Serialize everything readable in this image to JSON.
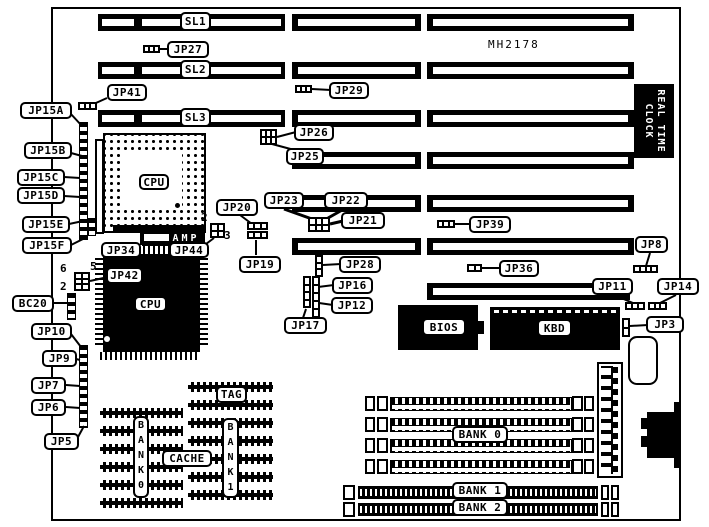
{
  "silkscreen": {
    "board_id": "MH2178",
    "rtc_line1": "REAL TIME",
    "rtc_line2": "CLOCK",
    "amp_label": "AMP"
  },
  "callouts": [
    {
      "name": "sl1-label",
      "text": "SL1",
      "x": 180,
      "y": 12,
      "w": 31,
      "h": 19
    },
    {
      "name": "sl2-label",
      "text": "SL2",
      "x": 180,
      "y": 60,
      "w": 31,
      "h": 19
    },
    {
      "name": "sl3-label",
      "text": "SL3",
      "x": 180,
      "y": 108,
      "w": 31,
      "h": 19
    },
    {
      "name": "jp27-label",
      "text": "JP27",
      "x": 167,
      "y": 41,
      "w": 42,
      "h": 17
    },
    {
      "name": "jp41-label",
      "text": "JP41",
      "x": 107,
      "y": 84,
      "w": 40,
      "h": 17
    },
    {
      "name": "jp29-label",
      "text": "JP29",
      "x": 329,
      "y": 82,
      "w": 40,
      "h": 17
    },
    {
      "name": "jp26-label",
      "text": "JP26",
      "x": 294,
      "y": 124,
      "w": 40,
      "h": 17
    },
    {
      "name": "jp25-label",
      "text": "JP25",
      "x": 286,
      "y": 148,
      "w": 38,
      "h": 17
    },
    {
      "name": "jp15a-label",
      "text": "JP15A",
      "x": 20,
      "y": 102,
      "w": 52,
      "h": 17
    },
    {
      "name": "jp15b-label",
      "text": "JP15B",
      "x": 24,
      "y": 142,
      "w": 48,
      "h": 17
    },
    {
      "name": "jp15c-label",
      "text": "JP15C",
      "x": 17,
      "y": 169,
      "w": 48,
      "h": 17
    },
    {
      "name": "jp15d-label",
      "text": "JP15D",
      "x": 17,
      "y": 187,
      "w": 48,
      "h": 17
    },
    {
      "name": "jp15e-label",
      "text": "JP15E",
      "x": 22,
      "y": 216,
      "w": 48,
      "h": 17
    },
    {
      "name": "jp15f-label",
      "text": "JP15F",
      "x": 22,
      "y": 237,
      "w": 50,
      "h": 17
    },
    {
      "name": "jp23-label",
      "text": "JP23",
      "x": 264,
      "y": 192,
      "w": 40,
      "h": 17
    },
    {
      "name": "jp22-label",
      "text": "JP22",
      "x": 324,
      "y": 192,
      "w": 44,
      "h": 17
    },
    {
      "name": "jp21-label",
      "text": "JP21",
      "x": 341,
      "y": 212,
      "w": 44,
      "h": 17
    },
    {
      "name": "jp20-label",
      "text": "JP20",
      "x": 216,
      "y": 199,
      "w": 42,
      "h": 17
    },
    {
      "name": "jp19-label",
      "text": "JP19",
      "x": 239,
      "y": 256,
      "w": 42,
      "h": 17
    },
    {
      "name": "jp39-label",
      "text": "JP39",
      "x": 469,
      "y": 216,
      "w": 42,
      "h": 17
    },
    {
      "name": "jp36-label",
      "text": "JP36",
      "x": 499,
      "y": 260,
      "w": 40,
      "h": 17
    },
    {
      "name": "jp8-label",
      "text": "JP8",
      "x": 635,
      "y": 236,
      "w": 33,
      "h": 17
    },
    {
      "name": "jp11-label",
      "text": "JP11",
      "x": 592,
      "y": 278,
      "w": 41,
      "h": 17
    },
    {
      "name": "jp14-label",
      "text": "JP14",
      "x": 657,
      "y": 278,
      "w": 42,
      "h": 17
    },
    {
      "name": "jp3-label",
      "text": "JP3",
      "x": 646,
      "y": 316,
      "w": 38,
      "h": 17
    },
    {
      "name": "jp28-label",
      "text": "JP28",
      "x": 339,
      "y": 256,
      "w": 42,
      "h": 17
    },
    {
      "name": "jp16-label",
      "text": "JP16",
      "x": 332,
      "y": 277,
      "w": 41,
      "h": 17
    },
    {
      "name": "jp12-label",
      "text": "JP12",
      "x": 331,
      "y": 297,
      "w": 42,
      "h": 17
    },
    {
      "name": "jp17-label",
      "text": "JP17",
      "x": 284,
      "y": 317,
      "w": 43,
      "h": 17
    },
    {
      "name": "jp34-label",
      "text": "JP34",
      "x": 101,
      "y": 242,
      "w": 40,
      "h": 16
    },
    {
      "name": "jp44-label",
      "text": "JP44",
      "x": 169,
      "y": 242,
      "w": 40,
      "h": 16
    },
    {
      "name": "jp42-label",
      "text": "JP42",
      "x": 106,
      "y": 267,
      "w": 37,
      "h": 17
    },
    {
      "name": "bc20-label",
      "text": "BC20",
      "x": 12,
      "y": 295,
      "w": 42,
      "h": 17
    },
    {
      "name": "jp10-label",
      "text": "JP10",
      "x": 31,
      "y": 323,
      "w": 41,
      "h": 17
    },
    {
      "name": "jp9-label",
      "text": "JP9",
      "x": 42,
      "y": 350,
      "w": 35,
      "h": 17
    },
    {
      "name": "jp7-label",
      "text": "JP7",
      "x": 31,
      "y": 377,
      "w": 35,
      "h": 17
    },
    {
      "name": "jp6-label",
      "text": "JP6",
      "x": 31,
      "y": 399,
      "w": 35,
      "h": 17
    },
    {
      "name": "jp5-label",
      "text": "JP5",
      "x": 44,
      "y": 433,
      "w": 35,
      "h": 17
    },
    {
      "name": "tag-label",
      "text": "TAG",
      "x": 216,
      "y": 386,
      "w": 31,
      "h": 17
    },
    {
      "name": "cache-label",
      "text": "CACHE",
      "x": 162,
      "y": 450,
      "w": 50,
      "h": 17
    },
    {
      "name": "bank0-label",
      "text": "BANK 0",
      "x": 452,
      "y": 426,
      "w": 56,
      "h": 17
    },
    {
      "name": "bank1-label",
      "text": "BANK 1",
      "x": 452,
      "y": 482,
      "w": 56,
      "h": 17
    },
    {
      "name": "bank2-label",
      "text": "BANK 2",
      "x": 452,
      "y": 499,
      "w": 56,
      "h": 17
    },
    {
      "name": "cpu-socket-label",
      "text": "CPU",
      "x": 139,
      "y": 174,
      "w": 30,
      "h": 16
    },
    {
      "name": "cpu-qfp-label",
      "text": "CPU",
      "x": 134,
      "y": 296,
      "w": 33,
      "h": 16
    },
    {
      "name": "bios-label",
      "text": "BIOS",
      "x": 422,
      "y": 318,
      "w": 44,
      "h": 18
    },
    {
      "name": "kbd-label",
      "text": "KBD",
      "x": 537,
      "y": 319,
      "w": 35,
      "h": 18
    }
  ],
  "vertical_labels": [
    {
      "name": "cache-bank0-vertical-label",
      "text": "BANK0",
      "x": 133,
      "y": 416,
      "w": 16,
      "h": 82
    },
    {
      "name": "cache-bank1-vertical-label",
      "text": "BANK1",
      "x": 222,
      "y": 418,
      "w": 17,
      "h": 80
    }
  ],
  "pin_numbers": [
    {
      "name": "pin-number-2-cpu",
      "text": "2",
      "x": 201,
      "y": 211
    },
    {
      "name": "pin-number-3-cpu",
      "text": "3",
      "x": 224,
      "y": 229
    },
    {
      "name": "pin-number-6-jp42",
      "text": "6",
      "x": 60,
      "y": 262
    },
    {
      "name": "pin-number-5-jp42",
      "text": "5",
      "x": 90,
      "y": 260
    },
    {
      "name": "pin-number-2-jp42",
      "text": "2",
      "x": 60,
      "y": 280
    }
  ],
  "slots": [
    {
      "name": "slot-sl1",
      "y": 14,
      "segs": [
        {
          "x": 98,
          "w": 187,
          "divider": true
        },
        {
          "x": 292,
          "w": 129
        },
        {
          "x": 427,
          "w": 207
        }
      ]
    },
    {
      "name": "slot-sl2",
      "y": 62,
      "segs": [
        {
          "x": 98,
          "w": 187,
          "divider": true
        },
        {
          "x": 292,
          "w": 129
        },
        {
          "x": 427,
          "w": 207
        }
      ]
    },
    {
      "name": "slot-sl3",
      "y": 110,
      "segs": [
        {
          "x": 98,
          "w": 187,
          "divider": true
        },
        {
          "x": 292,
          "w": 129
        },
        {
          "x": 427,
          "w": 207
        }
      ]
    },
    {
      "name": "slot-row4",
      "y": 152,
      "segs": [
        {
          "x": 292,
          "w": 129
        },
        {
          "x": 427,
          "w": 207
        }
      ]
    },
    {
      "name": "slot-row5",
      "y": 195,
      "segs": [
        {
          "x": 292,
          "w": 129
        },
        {
          "x": 427,
          "w": 207
        }
      ]
    },
    {
      "name": "slot-row6",
      "y": 238,
      "segs": [
        {
          "x": 292,
          "w": 129
        },
        {
          "x": 427,
          "w": 207
        }
      ]
    },
    {
      "name": "slot-row7",
      "y": 283,
      "segs": [
        {
          "x": 427,
          "w": 203,
          "ir": 14
        }
      ]
    }
  ],
  "jumpers": [
    {
      "name": "jp27-jumper",
      "x": 143,
      "y": 45,
      "w": 17,
      "h": 8,
      "c": 3,
      "r": 1
    },
    {
      "name": "jp41-jumper",
      "x": 78,
      "y": 102,
      "w": 19,
      "h": 8,
      "c": 3,
      "r": 1
    },
    {
      "name": "jp29-jumper",
      "x": 295,
      "y": 85,
      "w": 17,
      "h": 8,
      "c": 3,
      "r": 1
    },
    {
      "name": "jp26-jumper",
      "x": 260,
      "y": 129,
      "w": 17,
      "h": 16,
      "c": 3,
      "r": 2
    },
    {
      "name": "jp20-jumper-row1",
      "x": 247,
      "y": 222,
      "w": 21,
      "h": 8,
      "c": 3,
      "r": 1
    },
    {
      "name": "jp20-jumper-row2",
      "x": 247,
      "y": 231,
      "w": 21,
      "h": 8,
      "c": 3,
      "r": 1
    },
    {
      "name": "jp44-jumper",
      "x": 210,
      "y": 223,
      "w": 15,
      "h": 15,
      "c": 2,
      "r": 2
    },
    {
      "name": "jp21-jumper",
      "x": 308,
      "y": 217,
      "w": 22,
      "h": 15,
      "c": 3,
      "r": 2
    },
    {
      "name": "jp39-jumper",
      "x": 437,
      "y": 220,
      "w": 18,
      "h": 8,
      "c": 3,
      "r": 1
    },
    {
      "name": "jp36-jumper",
      "x": 467,
      "y": 264,
      "w": 15,
      "h": 8,
      "c": 2,
      "r": 1
    },
    {
      "name": "jp8-jumper",
      "x": 633,
      "y": 265,
      "w": 25,
      "h": 8,
      "c": 4,
      "r": 1
    },
    {
      "name": "jp11-jumper",
      "x": 625,
      "y": 302,
      "w": 20,
      "h": 8,
      "c": 3,
      "r": 1
    },
    {
      "name": "jp14-jumper",
      "x": 648,
      "y": 302,
      "w": 19,
      "h": 8,
      "c": 3,
      "r": 1
    },
    {
      "name": "jp3-jumper",
      "x": 622,
      "y": 318,
      "w": 8,
      "h": 19,
      "c": 1,
      "r": 2
    },
    {
      "name": "jp42-jumper",
      "x": 74,
      "y": 272,
      "w": 16,
      "h": 19,
      "c": 2,
      "r": 3
    },
    {
      "name": "jp28-jumper",
      "x": 315,
      "y": 255,
      "w": 8,
      "h": 22,
      "c": 1,
      "r": 3
    },
    {
      "name": "jp17-jumper-a",
      "x": 303,
      "y": 276,
      "w": 8,
      "h": 32,
      "c": 1,
      "r": 4
    },
    {
      "name": "jp17-jumper-b",
      "x": 312,
      "y": 276,
      "w": 8,
      "h": 42,
      "c": 1,
      "r": 5
    }
  ],
  "pin_strips": [
    {
      "name": "jp15-pin-strip",
      "x": 79,
      "y": 122,
      "w": 9,
      "h": 118
    },
    {
      "name": "jp15ef-pin-strip",
      "x": 88,
      "y": 218,
      "w": 8,
      "h": 18
    },
    {
      "name": "bc20-pin-strip",
      "x": 67,
      "y": 293,
      "w": 9,
      "h": 27
    },
    {
      "name": "jp5-jp10-pin-strip",
      "x": 79,
      "y": 345,
      "w": 9,
      "h": 83
    }
  ],
  "lines": [
    [
      160,
      49,
      170,
      49,
      2
    ],
    [
      107,
      98,
      87,
      107,
      2
    ],
    [
      312,
      89,
      331,
      90,
      2
    ],
    [
      277,
      137,
      296,
      132,
      2
    ],
    [
      272,
      144,
      298,
      151,
      2
    ],
    [
      284,
      209,
      312,
      219,
      3
    ],
    [
      344,
      209,
      328,
      218,
      3
    ],
    [
      330,
      224,
      343,
      221,
      3
    ],
    [
      240,
      215,
      252,
      224,
      2
    ],
    [
      256,
      255,
      256,
      240,
      2
    ],
    [
      214,
      238,
      206,
      244,
      2
    ],
    [
      455,
      224,
      471,
      224,
      2
    ],
    [
      482,
      268,
      501,
      268,
      2
    ],
    [
      650,
      253,
      646,
      266,
      2
    ],
    [
      614,
      295,
      633,
      303,
      2
    ],
    [
      676,
      295,
      660,
      303,
      2
    ],
    [
      630,
      326,
      648,
      325,
      2
    ],
    [
      323,
      265,
      341,
      264,
      2
    ],
    [
      318,
      287,
      334,
      285,
      2
    ],
    [
      319,
      303,
      333,
      305,
      2
    ],
    [
      306,
      309,
      303,
      318,
      2
    ],
    [
      90,
      281,
      108,
      277,
      2
    ],
    [
      54,
      303,
      68,
      303,
      2
    ],
    [
      71,
      334,
      81,
      347,
      2
    ],
    [
      76,
      359,
      80,
      360,
      2
    ],
    [
      66,
      385,
      80,
      386,
      2
    ],
    [
      66,
      407,
      80,
      408,
      2
    ],
    [
      78,
      437,
      84,
      426,
      2
    ],
    [
      70,
      113,
      82,
      126,
      2
    ],
    [
      71,
      153,
      82,
      156,
      2
    ],
    [
      64,
      177,
      80,
      178,
      2
    ],
    [
      64,
      196,
      80,
      197,
      2
    ],
    [
      69,
      224,
      83,
      221,
      2
    ],
    [
      71,
      245,
      85,
      238,
      2
    ]
  ],
  "cache_blocks": [
    {
      "name": "cache-bank0-chips",
      "x": 100,
      "w": 83,
      "y0": 408,
      "rows": 6,
      "step": 18
    },
    {
      "name": "cache-bank1-chips",
      "x": 188,
      "w": 85,
      "y0": 382,
      "rows": 7,
      "step": 18
    }
  ],
  "simm_bank0_rows": [
    394,
    415,
    436,
    457
  ],
  "simm_bank12_rows": [
    484,
    501
  ]
}
